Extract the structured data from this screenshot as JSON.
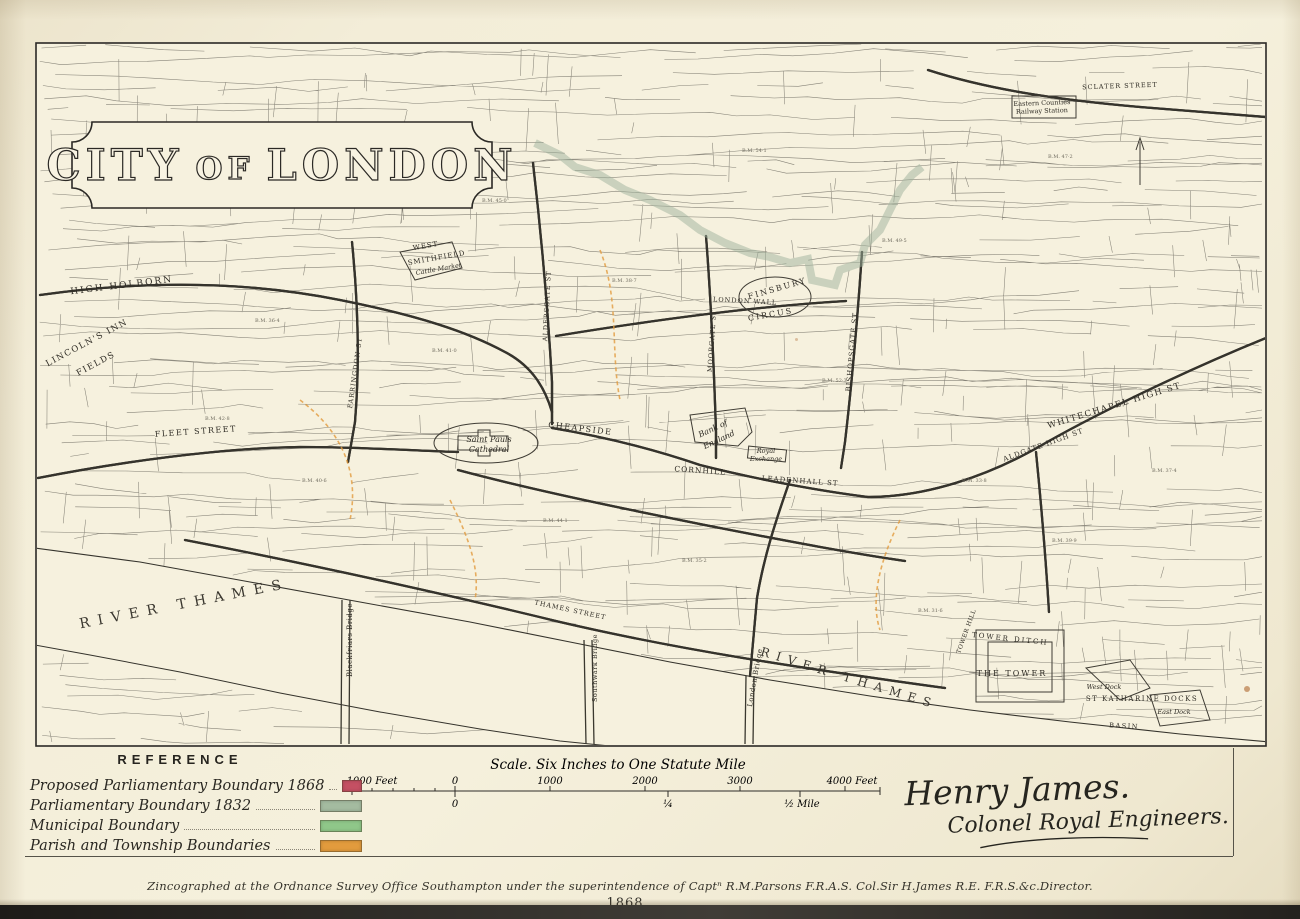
{
  "title": {
    "word1": "CITY",
    "word2": "OF",
    "word3": "LONDON"
  },
  "reference": {
    "heading": "REFERENCE",
    "items": [
      {
        "label": "Proposed Parliamentary Boundary 1868",
        "color": "#c45063"
      },
      {
        "label": "Parliamentary Boundary 1832",
        "color": "#a4bba0"
      },
      {
        "label": "Municipal Boundary",
        "color": "#8fc789"
      },
      {
        "label": "Parish and Township Boundaries",
        "color": "#e29b3d"
      }
    ]
  },
  "scale_bar": {
    "title": "Scale. Six Inches to One Statute Mile",
    "top_labels": [
      "1000 Feet",
      "0",
      "1000",
      "2000",
      "3000",
      "4000 Feet"
    ],
    "bottom_labels": [
      "0",
      "¼",
      "½ Mile"
    ]
  },
  "signature": {
    "line1": "Henry James.",
    "line2": "Colonel Royal Engineers."
  },
  "imprint": "Zincographed at the Ordnance Survey Office Southampton under the superintendence of Captⁿ R.M.Parsons F.R.A.S. Col.Sir H.James R.E. F.R.S.&c.Director.",
  "year_mark": "1868",
  "map": {
    "boundary_colors": {
      "proposed_1868": "#c45063",
      "boundary_1832": "#9eb29b",
      "municipal": "#93c48c",
      "parish": "#e29b3d"
    },
    "labels": [
      {
        "text": "HIGH HOLBORN",
        "x": 122,
        "y": 288,
        "rot": -7,
        "size": 9,
        "ls": 2,
        "cls": "s"
      },
      {
        "text": "LINCOLN'S INN",
        "x": 88,
        "y": 345,
        "rot": -28,
        "size": 8.5,
        "ls": 1.5,
        "cls": "s"
      },
      {
        "text": "FIELDS",
        "x": 97,
        "y": 366,
        "rot": -28,
        "size": 8.5,
        "ls": 1.5,
        "cls": "s"
      },
      {
        "text": "FLEET STREET",
        "x": 196,
        "y": 434,
        "rot": -4,
        "size": 8,
        "ls": 1.5,
        "cls": "s"
      },
      {
        "text": "CHEAPSIDE",
        "x": 580,
        "y": 431,
        "rot": 7,
        "size": 8,
        "ls": 1.5,
        "cls": "s"
      },
      {
        "text": "Saint Pauls",
        "x": 489,
        "y": 442,
        "rot": 0,
        "size": 8,
        "ls": 0,
        "cls": "i"
      },
      {
        "text": "Cathedral",
        "x": 489,
        "y": 452,
        "rot": 0,
        "size": 8,
        "ls": 0,
        "cls": "i"
      },
      {
        "text": "Bank of",
        "x": 714,
        "y": 431,
        "rot": -25,
        "size": 8,
        "ls": 0,
        "cls": "i"
      },
      {
        "text": "England",
        "x": 720,
        "y": 442,
        "rot": -25,
        "size": 8,
        "ls": 0,
        "cls": "i"
      },
      {
        "text": "Royal",
        "x": 766,
        "y": 453,
        "rot": 0,
        "size": 6.5,
        "ls": 0,
        "cls": "i"
      },
      {
        "text": "Exchange",
        "x": 766,
        "y": 461,
        "rot": 0,
        "size": 6.5,
        "ls": 0,
        "cls": "i"
      },
      {
        "text": "CORNHILL",
        "x": 700,
        "y": 473,
        "rot": 4,
        "size": 7.5,
        "ls": 1,
        "cls": "s"
      },
      {
        "text": "LEADENHALL ST",
        "x": 800,
        "y": 483,
        "rot": 4,
        "size": 7,
        "ls": 1,
        "cls": "s"
      },
      {
        "text": "FINSBURY",
        "x": 778,
        "y": 291,
        "rot": -16,
        "size": 8,
        "ls": 2,
        "cls": "s"
      },
      {
        "text": "CIRCUS",
        "x": 771,
        "y": 317,
        "rot": -10,
        "size": 8,
        "ls": 2,
        "cls": "s"
      },
      {
        "text": "WEST",
        "x": 426,
        "y": 248,
        "rot": -10,
        "size": 7,
        "ls": 1,
        "cls": "s"
      },
      {
        "text": "SMITHFIELD",
        "x": 437,
        "y": 260,
        "rot": -10,
        "size": 7,
        "ls": 1,
        "cls": "s"
      },
      {
        "text": "Cattle Market",
        "x": 439,
        "y": 271,
        "rot": -10,
        "size": 6.5,
        "ls": 0,
        "cls": "i"
      },
      {
        "text": "LONDON WALL",
        "x": 745,
        "y": 303,
        "rot": 3,
        "size": 6.5,
        "ls": 1,
        "cls": "s"
      },
      {
        "text": "WHITECHAPEL HIGH ST",
        "x": 1115,
        "y": 408,
        "rot": -17,
        "size": 8.5,
        "ls": 1.5,
        "cls": "s"
      },
      {
        "text": "ALDGATE HIGH ST",
        "x": 1044,
        "y": 447,
        "rot": -20,
        "size": 7,
        "ls": 1,
        "cls": "s"
      },
      {
        "text": "BISHOPSGATE ST",
        "x": 854,
        "y": 352,
        "rot": -85,
        "size": 7,
        "ls": 1,
        "cls": "s"
      },
      {
        "text": "MOORGATE ST",
        "x": 714,
        "y": 341,
        "rot": -86,
        "size": 6.5,
        "ls": 1,
        "cls": "s"
      },
      {
        "text": "ALDERSGATE ST",
        "x": 549,
        "y": 306,
        "rot": -87,
        "size": 6.5,
        "ls": 1,
        "cls": "s"
      },
      {
        "text": "FARRINGDON ST",
        "x": 357,
        "y": 373,
        "rot": -82,
        "size": 6.5,
        "ls": 1,
        "cls": "s"
      },
      {
        "text": "THAMES STREET",
        "x": 570,
        "y": 612,
        "rot": 12,
        "size": 6.5,
        "ls": 1,
        "cls": "s"
      },
      {
        "text": "RIVER THAMES",
        "x": 185,
        "y": 608,
        "rot": -11,
        "size": 14,
        "ls": 8,
        "cls": "w"
      },
      {
        "text": "RIVER THAMES",
        "x": 848,
        "y": 682,
        "rot": 17,
        "size": 12,
        "ls": 7,
        "cls": "w"
      },
      {
        "text": "Blackfriars Bridge",
        "x": 352,
        "y": 640,
        "rot": -90,
        "size": 7,
        "ls": 0.5,
        "cls": "p"
      },
      {
        "text": "Southwark Bridge",
        "x": 597,
        "y": 668,
        "rot": -90,
        "size": 6.5,
        "ls": 0.5,
        "cls": "p"
      },
      {
        "text": "London Bridge",
        "x": 757,
        "y": 678,
        "rot": -80,
        "size": 7,
        "ls": 0.5,
        "cls": "p"
      },
      {
        "text": "TOWER DITCH",
        "x": 1010,
        "y": 641,
        "rot": 6,
        "size": 7,
        "ls": 2,
        "cls": "s"
      },
      {
        "text": "THE TOWER",
        "x": 1012,
        "y": 676,
        "rot": 0,
        "size": 8,
        "ls": 2,
        "cls": "s"
      },
      {
        "text": "ST KATHARINE DOCKS",
        "x": 1142,
        "y": 701,
        "rot": 0,
        "size": 7,
        "ls": 1.5,
        "cls": "s"
      },
      {
        "text": "West Dock",
        "x": 1104,
        "y": 689,
        "rot": 0,
        "size": 6.5,
        "ls": 0,
        "cls": "i"
      },
      {
        "text": "East Dock",
        "x": 1174,
        "y": 714,
        "rot": 0,
        "size": 6.5,
        "ls": 0,
        "cls": "i"
      },
      {
        "text": "BASIN",
        "x": 1124,
        "y": 728,
        "rot": 3,
        "size": 6.5,
        "ls": 1.5,
        "cls": "s"
      },
      {
        "text": "Eastern Counties",
        "x": 1042,
        "y": 105,
        "rot": -2,
        "size": 6.5,
        "ls": 0,
        "cls": "p"
      },
      {
        "text": "Railway Station",
        "x": 1042,
        "y": 113,
        "rot": -2,
        "size": 6.5,
        "ls": 0,
        "cls": "p"
      },
      {
        "text": "SCLATER STREET",
        "x": 1120,
        "y": 88,
        "rot": -2,
        "size": 6.5,
        "ls": 1,
        "cls": "s"
      },
      {
        "text": "TOWER HILL",
        "x": 968,
        "y": 632,
        "rot": -70,
        "size": 6,
        "ls": 0.5,
        "cls": "s"
      }
    ],
    "bench_marks": [
      {
        "t": "B.M. 36·4",
        "x": 255,
        "y": 322
      },
      {
        "t": "B.M. 47·2",
        "x": 1048,
        "y": 158
      },
      {
        "t": "B.M. 41·0",
        "x": 432,
        "y": 352
      },
      {
        "t": "B.M. 38·7",
        "x": 612,
        "y": 282
      },
      {
        "t": "B.M. 44·1",
        "x": 543,
        "y": 522
      },
      {
        "t": "B.M. 52·3",
        "x": 822,
        "y": 382
      },
      {
        "t": "B.M. 33·8",
        "x": 962,
        "y": 482
      },
      {
        "t": "B.M. 40·6",
        "x": 302,
        "y": 482
      },
      {
        "t": "B.M. 35·2",
        "x": 682,
        "y": 562
      },
      {
        "t": "B.M. 39·9",
        "x": 1052,
        "y": 542
      },
      {
        "t": "B.M. 49·5",
        "x": 882,
        "y": 242
      },
      {
        "t": "B.M. 45·0",
        "x": 482,
        "y": 202
      },
      {
        "t": "B.M. 54·1",
        "x": 742,
        "y": 152
      },
      {
        "t": "B.M. 37·4",
        "x": 1152,
        "y": 472
      },
      {
        "t": "B.M. 42·8",
        "x": 205,
        "y": 420
      },
      {
        "t": "B.M. 31·6",
        "x": 918,
        "y": 612
      }
    ]
  }
}
